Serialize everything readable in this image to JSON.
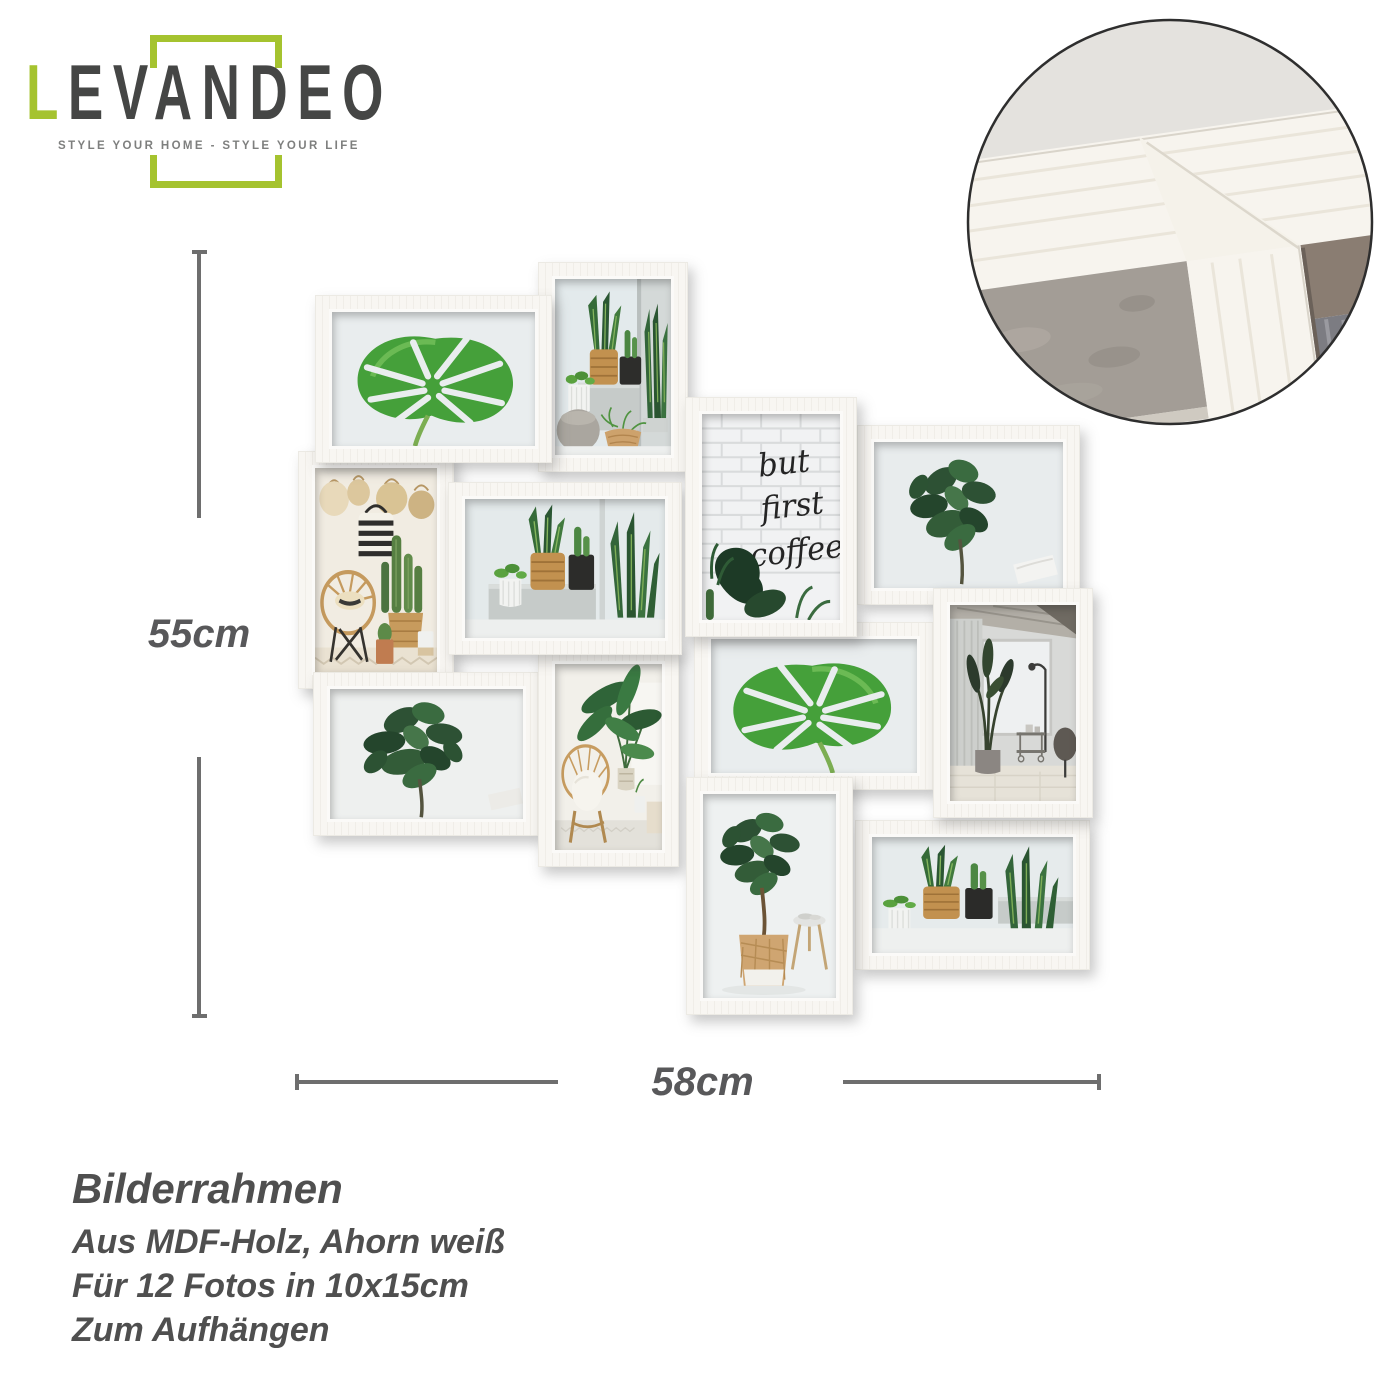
{
  "brand": {
    "name": "LEVANDEO",
    "name_accent_letter": "L",
    "name_rest": "EVANDEO",
    "tagline": "STYLE YOUR HOME - STYLE YOUR LIFE",
    "accent_color": "#a5c32f",
    "name_color": "#454645",
    "tagline_color": "#7e7f7e"
  },
  "detail_view": {
    "name": "frame-corner-close-up",
    "shape": "circle",
    "frame_color": "#f7f4ee",
    "wall_color": "#a39d96"
  },
  "dimensions": {
    "height_label": "55cm",
    "width_label": "58cm",
    "line_color": "#6e6e6e",
    "label_color": "#58585a"
  },
  "product_info": {
    "title": "Bilderrahmen",
    "lines": [
      "Aus MDF-Holz, Ahorn weiß",
      "Für 12 Fotos in 10x15cm",
      "Zum Aufhängen"
    ],
    "text_color": "#4f4f4f"
  },
  "collage": {
    "photo_count": 12,
    "frame_color": "#f8f6f2",
    "coffee_text": [
      "but",
      "first",
      "coffee"
    ],
    "frames": [
      {
        "id": 1,
        "motif": "monstera-leaf",
        "orientation": "landscape"
      },
      {
        "id": 2,
        "motif": "shelf-plants",
        "orientation": "portrait"
      },
      {
        "id": 3,
        "motif": "baskets-and-chair",
        "orientation": "portrait"
      },
      {
        "id": 4,
        "motif": "potted-plants",
        "orientation": "landscape"
      },
      {
        "id": 5,
        "motif": "coffee-lettering",
        "orientation": "portrait"
      },
      {
        "id": 6,
        "motif": "fiddle-leaf",
        "orientation": "landscape"
      },
      {
        "id": 7,
        "motif": "fiddle-leaf-bush",
        "orientation": "landscape"
      },
      {
        "id": 8,
        "motif": "peacock-chair",
        "orientation": "portrait"
      },
      {
        "id": 9,
        "motif": "monstera-leaf",
        "orientation": "landscape"
      },
      {
        "id": 10,
        "motif": "bright-room",
        "orientation": "portrait"
      },
      {
        "id": 11,
        "motif": "plant-in-basket",
        "orientation": "portrait"
      },
      {
        "id": 12,
        "motif": "snake-plants",
        "orientation": "landscape"
      }
    ]
  }
}
